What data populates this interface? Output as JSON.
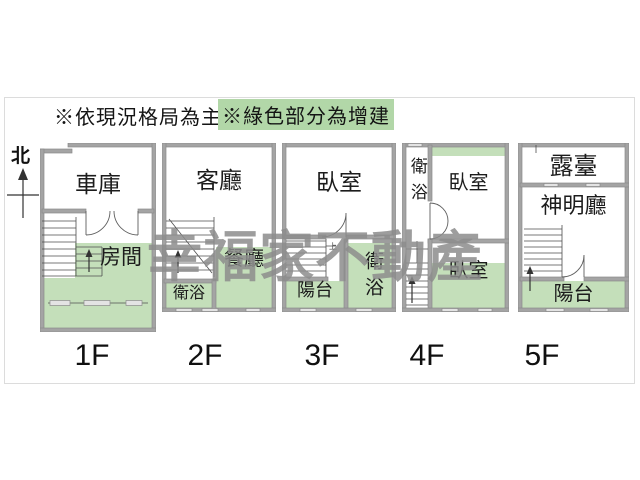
{
  "header": {
    "note_main": "※依現況格局為主",
    "note_green": "※綠色部分為增建"
  },
  "compass": {
    "label": "北"
  },
  "watermark": {
    "text": "幸福家不動產"
  },
  "floors": [
    {
      "label": "1F",
      "rooms": {
        "garage": "車庫",
        "room": "房間"
      }
    },
    {
      "label": "2F",
      "rooms": {
        "living": "客廳",
        "dining": "餐廳",
        "bath": "衛浴"
      }
    },
    {
      "label": "3F",
      "rooms": {
        "bedroom": "臥室",
        "bath": "衛浴",
        "balcony": "陽台"
      },
      "stairs_note": "上"
    },
    {
      "label": "4F",
      "rooms": {
        "bath": "衛浴",
        "bedroom_upper": "臥室",
        "bedroom_lower": "臥室"
      }
    },
    {
      "label": "5F",
      "rooms": {
        "terrace": "露臺",
        "shrine": "神明廳",
        "balcony": "陽台"
      }
    }
  ],
  "colors": {
    "addition_green": "#c4dfba",
    "note_highlight_green": "#b2d7a8",
    "wall_gray": "#a4a4a4",
    "watermark_gray": "#8d8d8d"
  }
}
